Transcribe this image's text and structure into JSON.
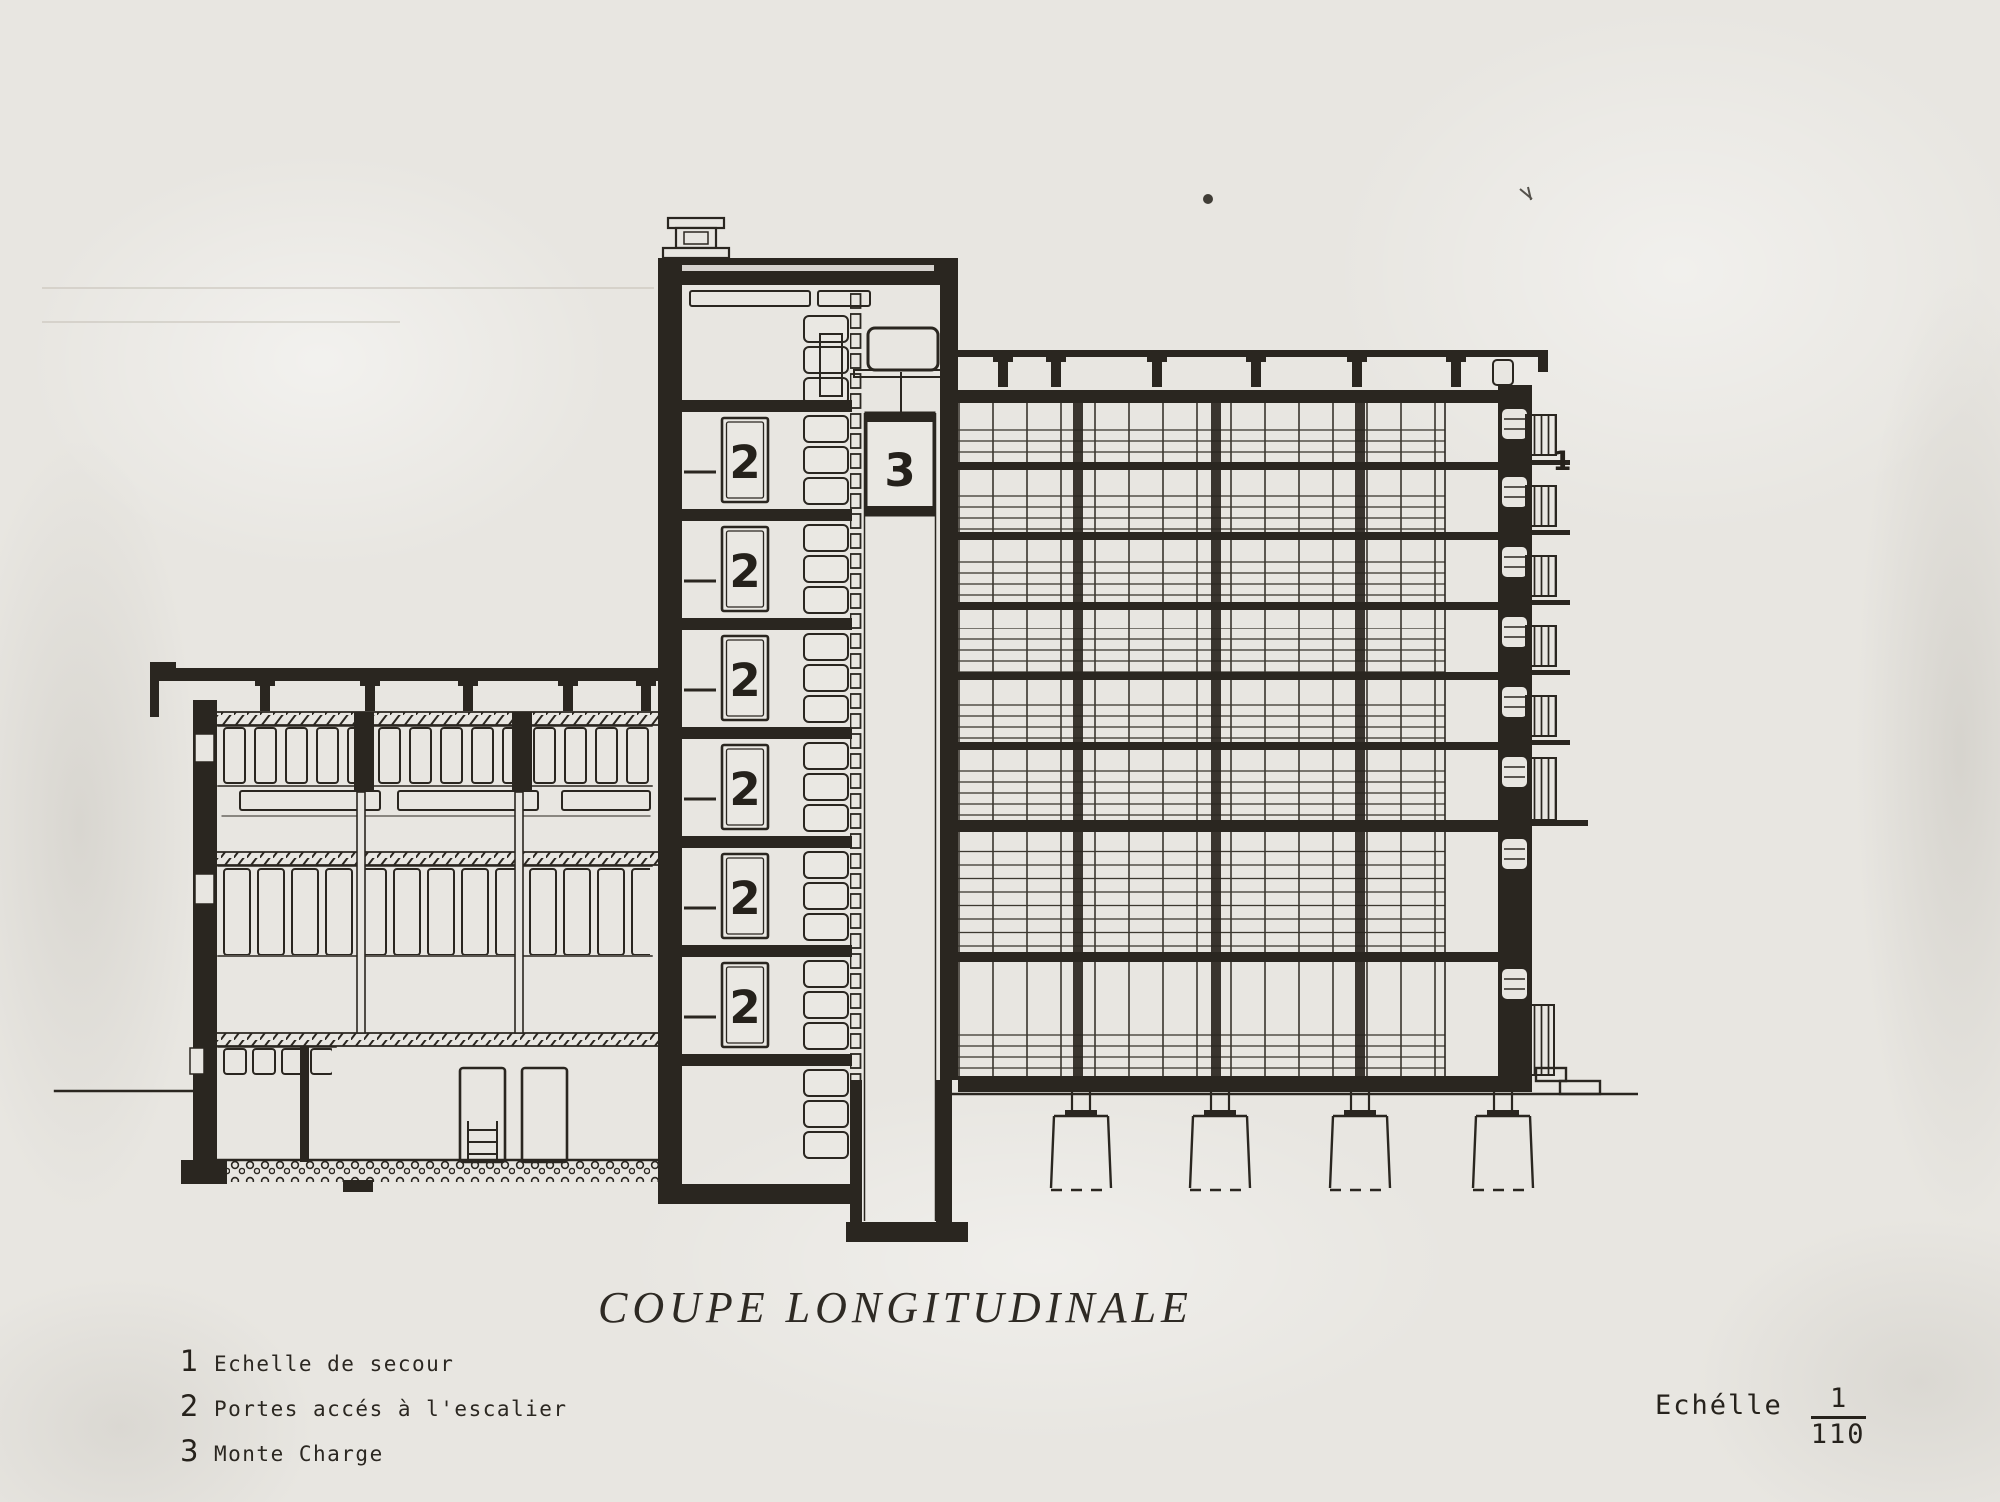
{
  "paper": {
    "background": "#e8e6e1",
    "ink": "#2a2620"
  },
  "title": "COUPE LONGITUDINALE",
  "legend": [
    {
      "num": "1",
      "label": "Echelle de secour"
    },
    {
      "num": "2",
      "label": "Portes accés à l'escalier"
    },
    {
      "num": "3",
      "label": "Monte Charge"
    }
  ],
  "scale_note": {
    "word": "Echélle",
    "numerator": "1",
    "denominator": "110"
  },
  "drawing_labels": {
    "stair_door": "2",
    "freight_elevator": "3",
    "fire_escape": "1"
  }
}
